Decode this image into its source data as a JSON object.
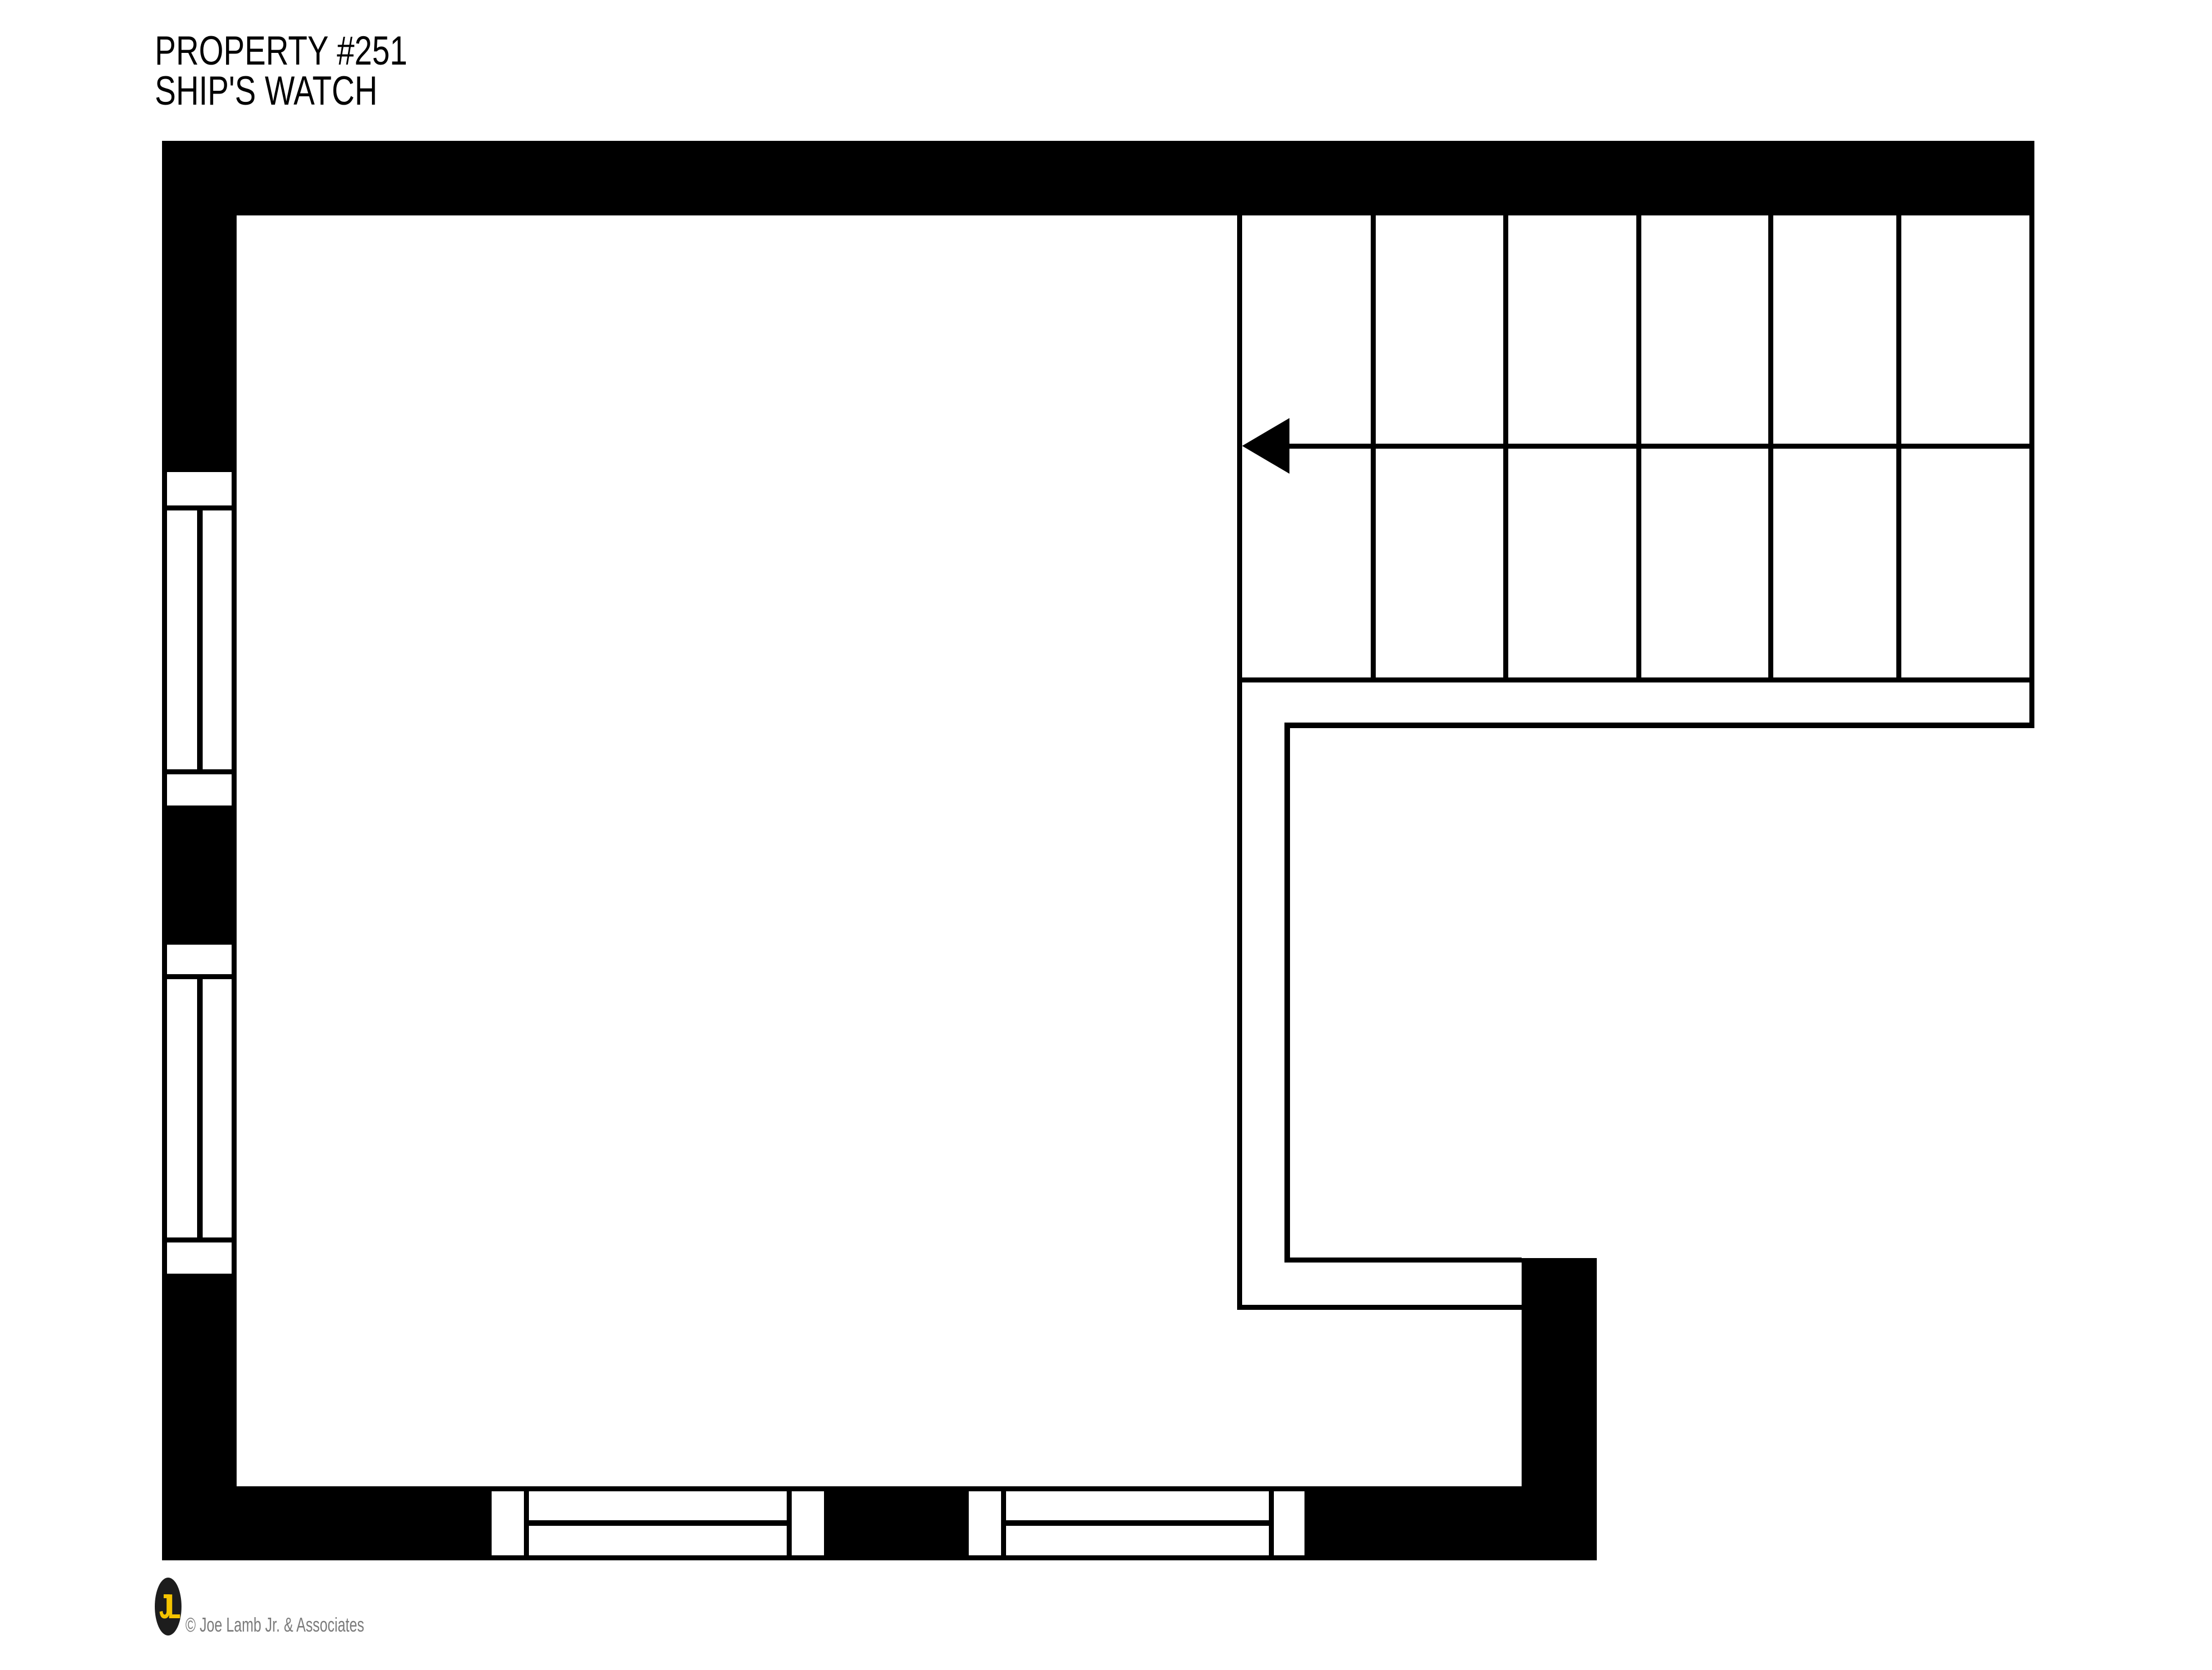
{
  "title": {
    "line1": "PROPERTY #251",
    "line2": "SHIP'S WATCH"
  },
  "footer": {
    "logo_monogram": "JL",
    "copyright": "© Joe Lamb Jr. & Associates"
  },
  "colors": {
    "ink": "#000000",
    "background": "#ffffff",
    "logo_background": "#1d1d1d",
    "logo_monogram_color": "#f5c400",
    "copyright_color": "#7b7b7b"
  },
  "plan": {
    "type": "floor-plan",
    "stairs": {
      "treads_per_flight": 6,
      "flights_shown": 2,
      "direction_arrow": "left"
    },
    "windows": {
      "left_wall_count": 2,
      "bottom_wall_count": 2
    }
  }
}
